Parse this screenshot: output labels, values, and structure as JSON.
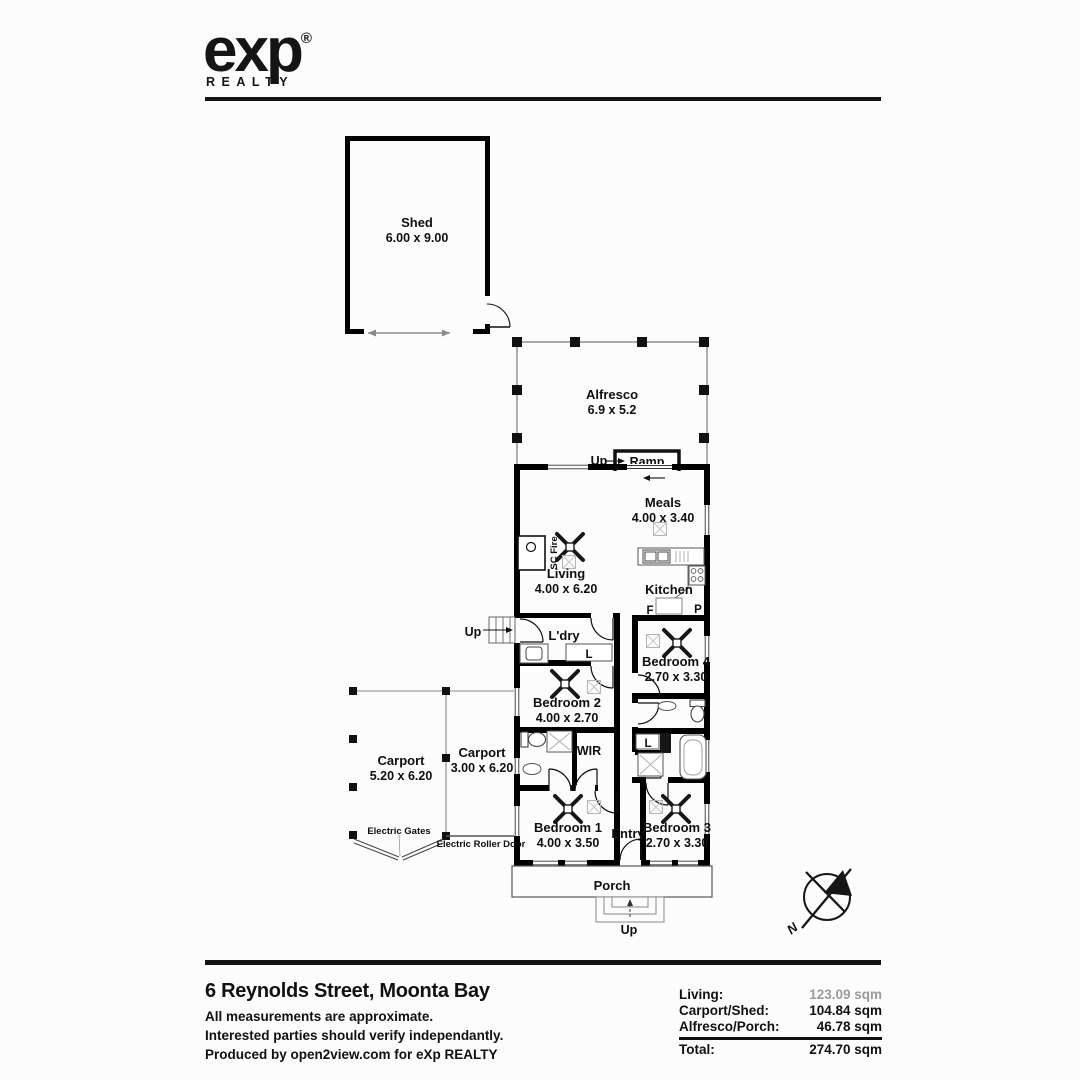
{
  "brand": {
    "logo": "exp",
    "registered": "®",
    "sub": "REALTY"
  },
  "plan": {
    "shed": {
      "name": "Shed",
      "dims": "6.00 x 9.00"
    },
    "alfresco": {
      "name": "Alfresco",
      "dims": "6.9 x 5.2"
    },
    "ramp": {
      "name": "Ramp",
      "up": "Up"
    },
    "meals": {
      "name": "Meals",
      "dims": "4.00 x 3.40"
    },
    "living": {
      "name": "Living",
      "dims": "4.00 x 6.20"
    },
    "sc_fire": "SC Fire",
    "kitchen": {
      "name": "Kitchen",
      "fridge": "F",
      "pantry": "P"
    },
    "laundry": {
      "name": "L'dry",
      "linen": "L",
      "up": "Up"
    },
    "bedroom4": {
      "name": "Bedroom 4",
      "dims": "2.70 x 3.30"
    },
    "bedroom2": {
      "name": "Bedroom 2",
      "dims": "4.00 x 2.70"
    },
    "wir": "WIR",
    "bath_linen": "L",
    "bedroom1": {
      "name": "Bedroom 1",
      "dims": "4.00 x 3.50"
    },
    "entry": "Entry",
    "bedroom3": {
      "name": "Bedroom 3",
      "dims": "2.70 x 3.30"
    },
    "porch": {
      "name": "Porch",
      "up": "Up"
    },
    "carport_large": {
      "name": "Carport",
      "dims": "5.20 x 6.20"
    },
    "carport_small": {
      "name": "Carport",
      "dims": "3.00 x 6.20"
    },
    "electric_gates": "Electric Gates",
    "electric_roller_door": "Electric Roller Door",
    "compass_n": "N"
  },
  "footer": {
    "address": "6 Reynolds Street, Moonta Bay",
    "note1": "All measurements are approximate.",
    "note2": "Interested parties should verify independantly.",
    "note3": "Produced by open2view.com for eXp REALTY",
    "areas": [
      {
        "label": "Living:",
        "value": "123.09 sqm"
      },
      {
        "label": "Carport/Shed:",
        "value": "104.84 sqm"
      },
      {
        "label": "Alfresco/Porch:",
        "value": "46.78 sqm"
      },
      {
        "label": "Total:",
        "value": "274.70 sqm"
      }
    ]
  },
  "colors": {
    "ink": "#111111",
    "wall": "#000000",
    "muted_value": "#9a9a9a"
  }
}
